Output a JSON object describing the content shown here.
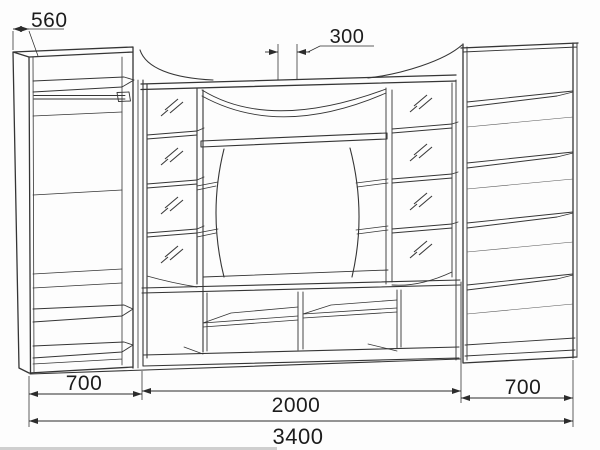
{
  "drawing_title": "wall-unit-assembly-drawing",
  "dimensions": {
    "side_depth": "560",
    "top_center": "300",
    "left_section_width": "700",
    "center_section_width": "2000",
    "right_section_width": "700",
    "overall_width": "3400"
  },
  "colors": {
    "line": "#353535",
    "background": "#fdfdfd",
    "dimension_text": "#1c1c1c",
    "bottom_scan_strip": "#cfcfcf"
  }
}
